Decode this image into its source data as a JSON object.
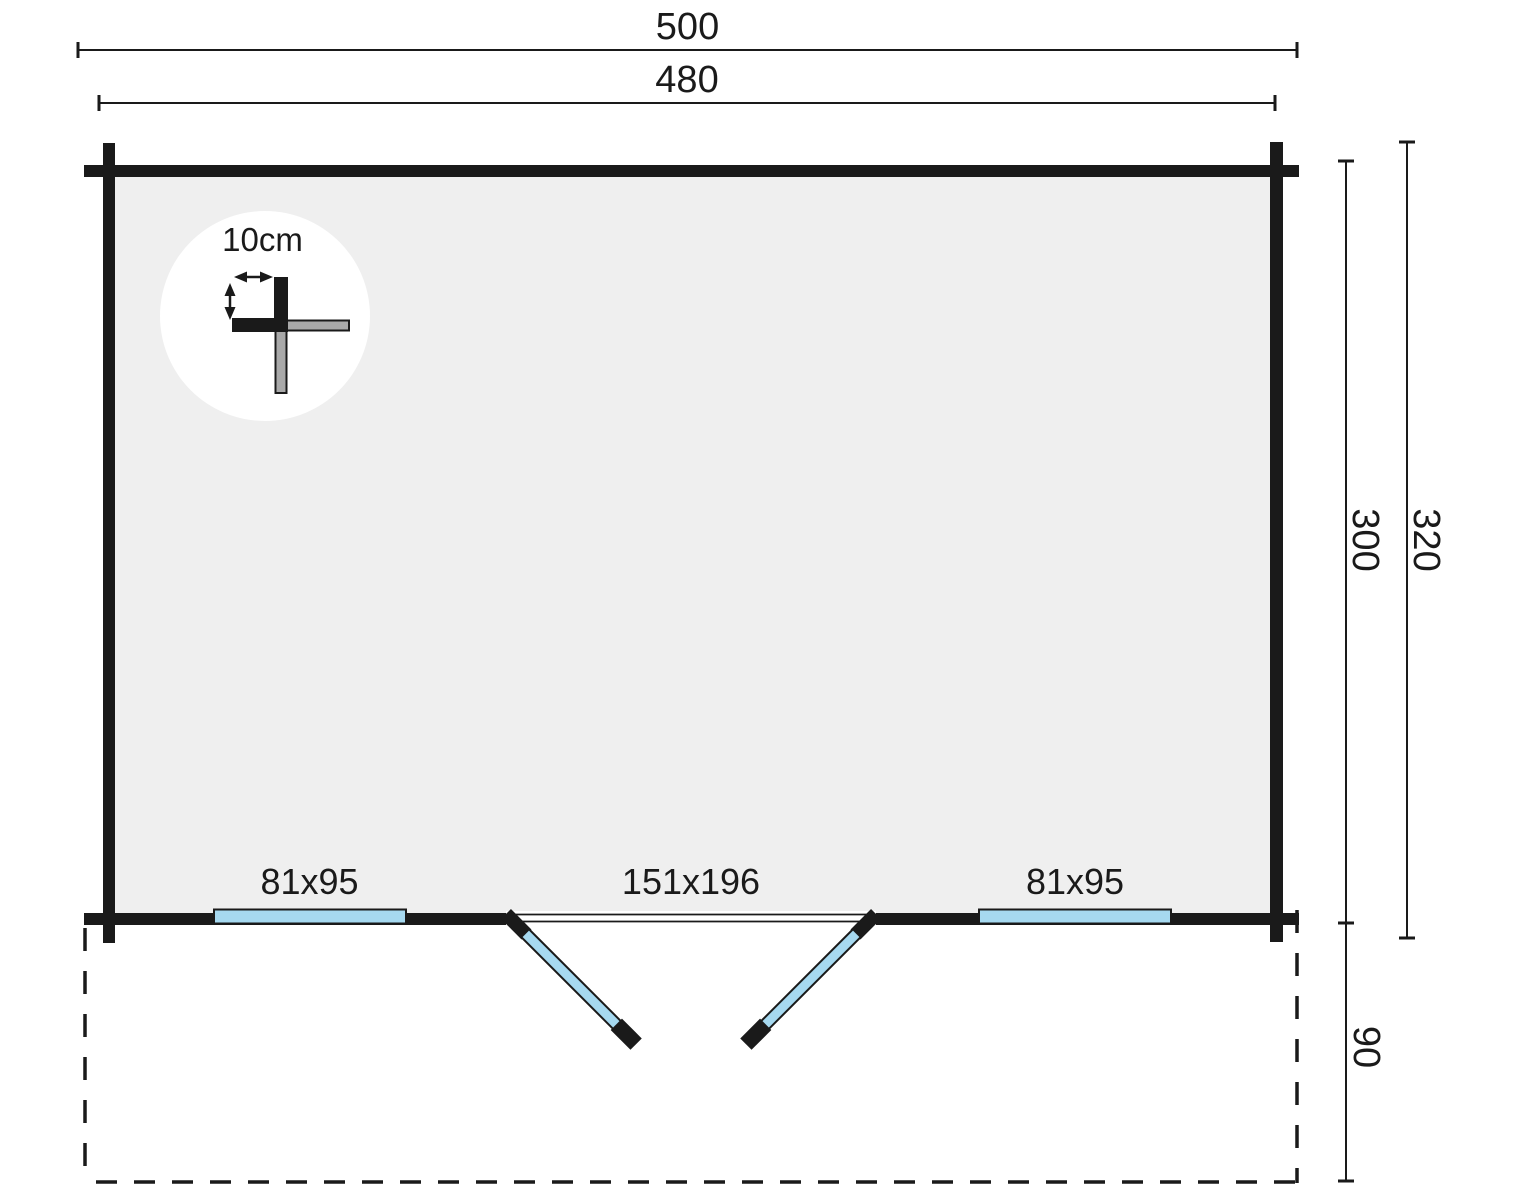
{
  "plan": {
    "dimensions": {
      "overall_width": "500",
      "shell_width": "480",
      "inner_depth": "300",
      "overall_depth": "320",
      "porch_depth": "90",
      "log_thickness": "10cm"
    },
    "openings": {
      "left_window": "81x95",
      "double_door": "151x196",
      "right_window": "81x95"
    },
    "colors": {
      "wall": "#1a1a1a",
      "interior_fill": "#efefef",
      "glazing_blue": "#a6d9f0",
      "detail_gray": "#a9a9a9"
    }
  }
}
